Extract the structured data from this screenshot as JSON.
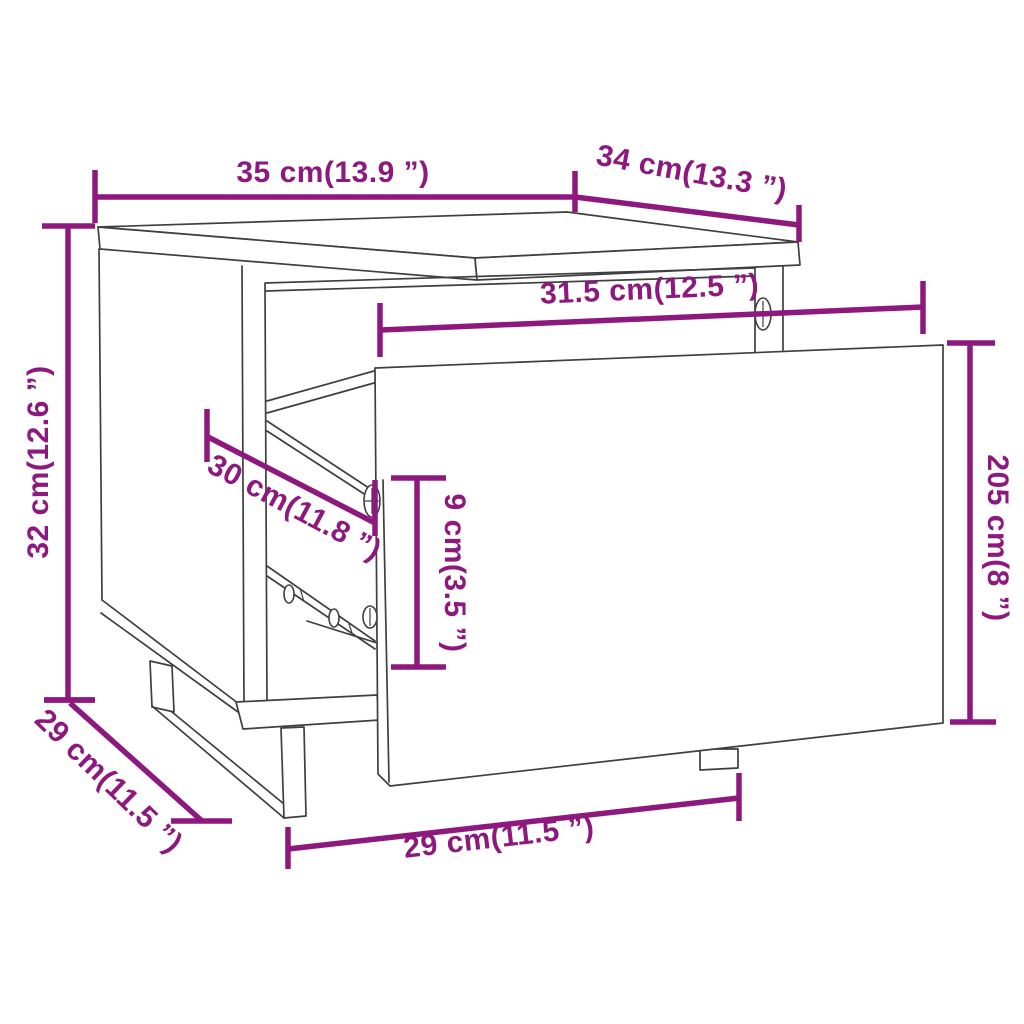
{
  "page": {
    "background": "#ffffff",
    "title": "Bedside cabinet dimensional drawing"
  },
  "diagram": {
    "type": "furniture-dimension-diagram",
    "subject": "bedside cabinet with pulled-out drawer",
    "colors": {
      "dimension": "#8D187E",
      "outline": "#3F3F3F",
      "fill": "#FFFFFF"
    },
    "labels": {
      "top_width": "35 cm(13.9 ”)",
      "top_depth": "34 cm(13.3 ”)",
      "inner_width": "31.5 cm(12.5 ”)",
      "overall_height": "32 cm(12.6 ”)",
      "inner_depth": "30 cm(11.8 ”)",
      "drawer_side_height": "9 cm(3.5 ”)",
      "drawer_front_height": "205 cm(8 ”)",
      "base_depth": "29 cm(11.5 ”)",
      "base_width": "29 cm(11.5 ”)"
    }
  }
}
